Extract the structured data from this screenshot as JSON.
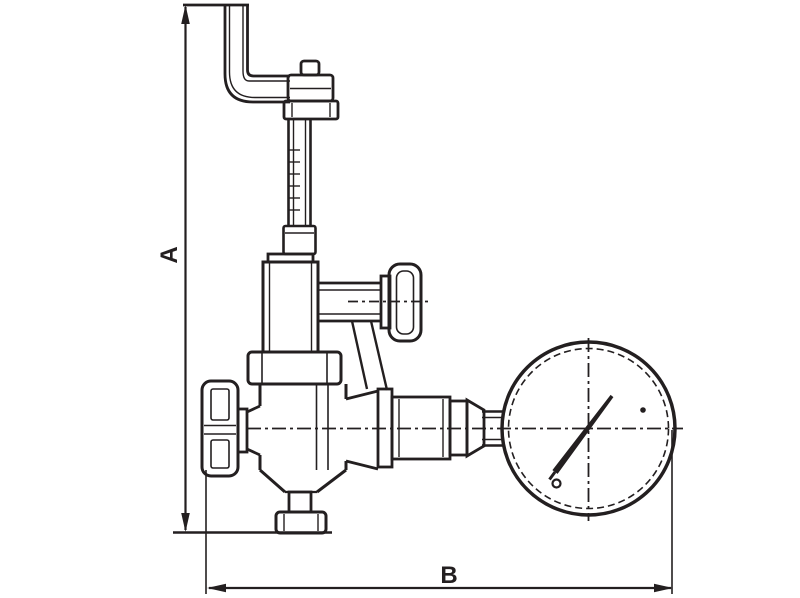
{
  "dimensions": {
    "a": {
      "label": "A"
    },
    "b": {
      "label": "B"
    }
  },
  "colors": {
    "line": "#231f20",
    "background": "#ffffff"
  }
}
